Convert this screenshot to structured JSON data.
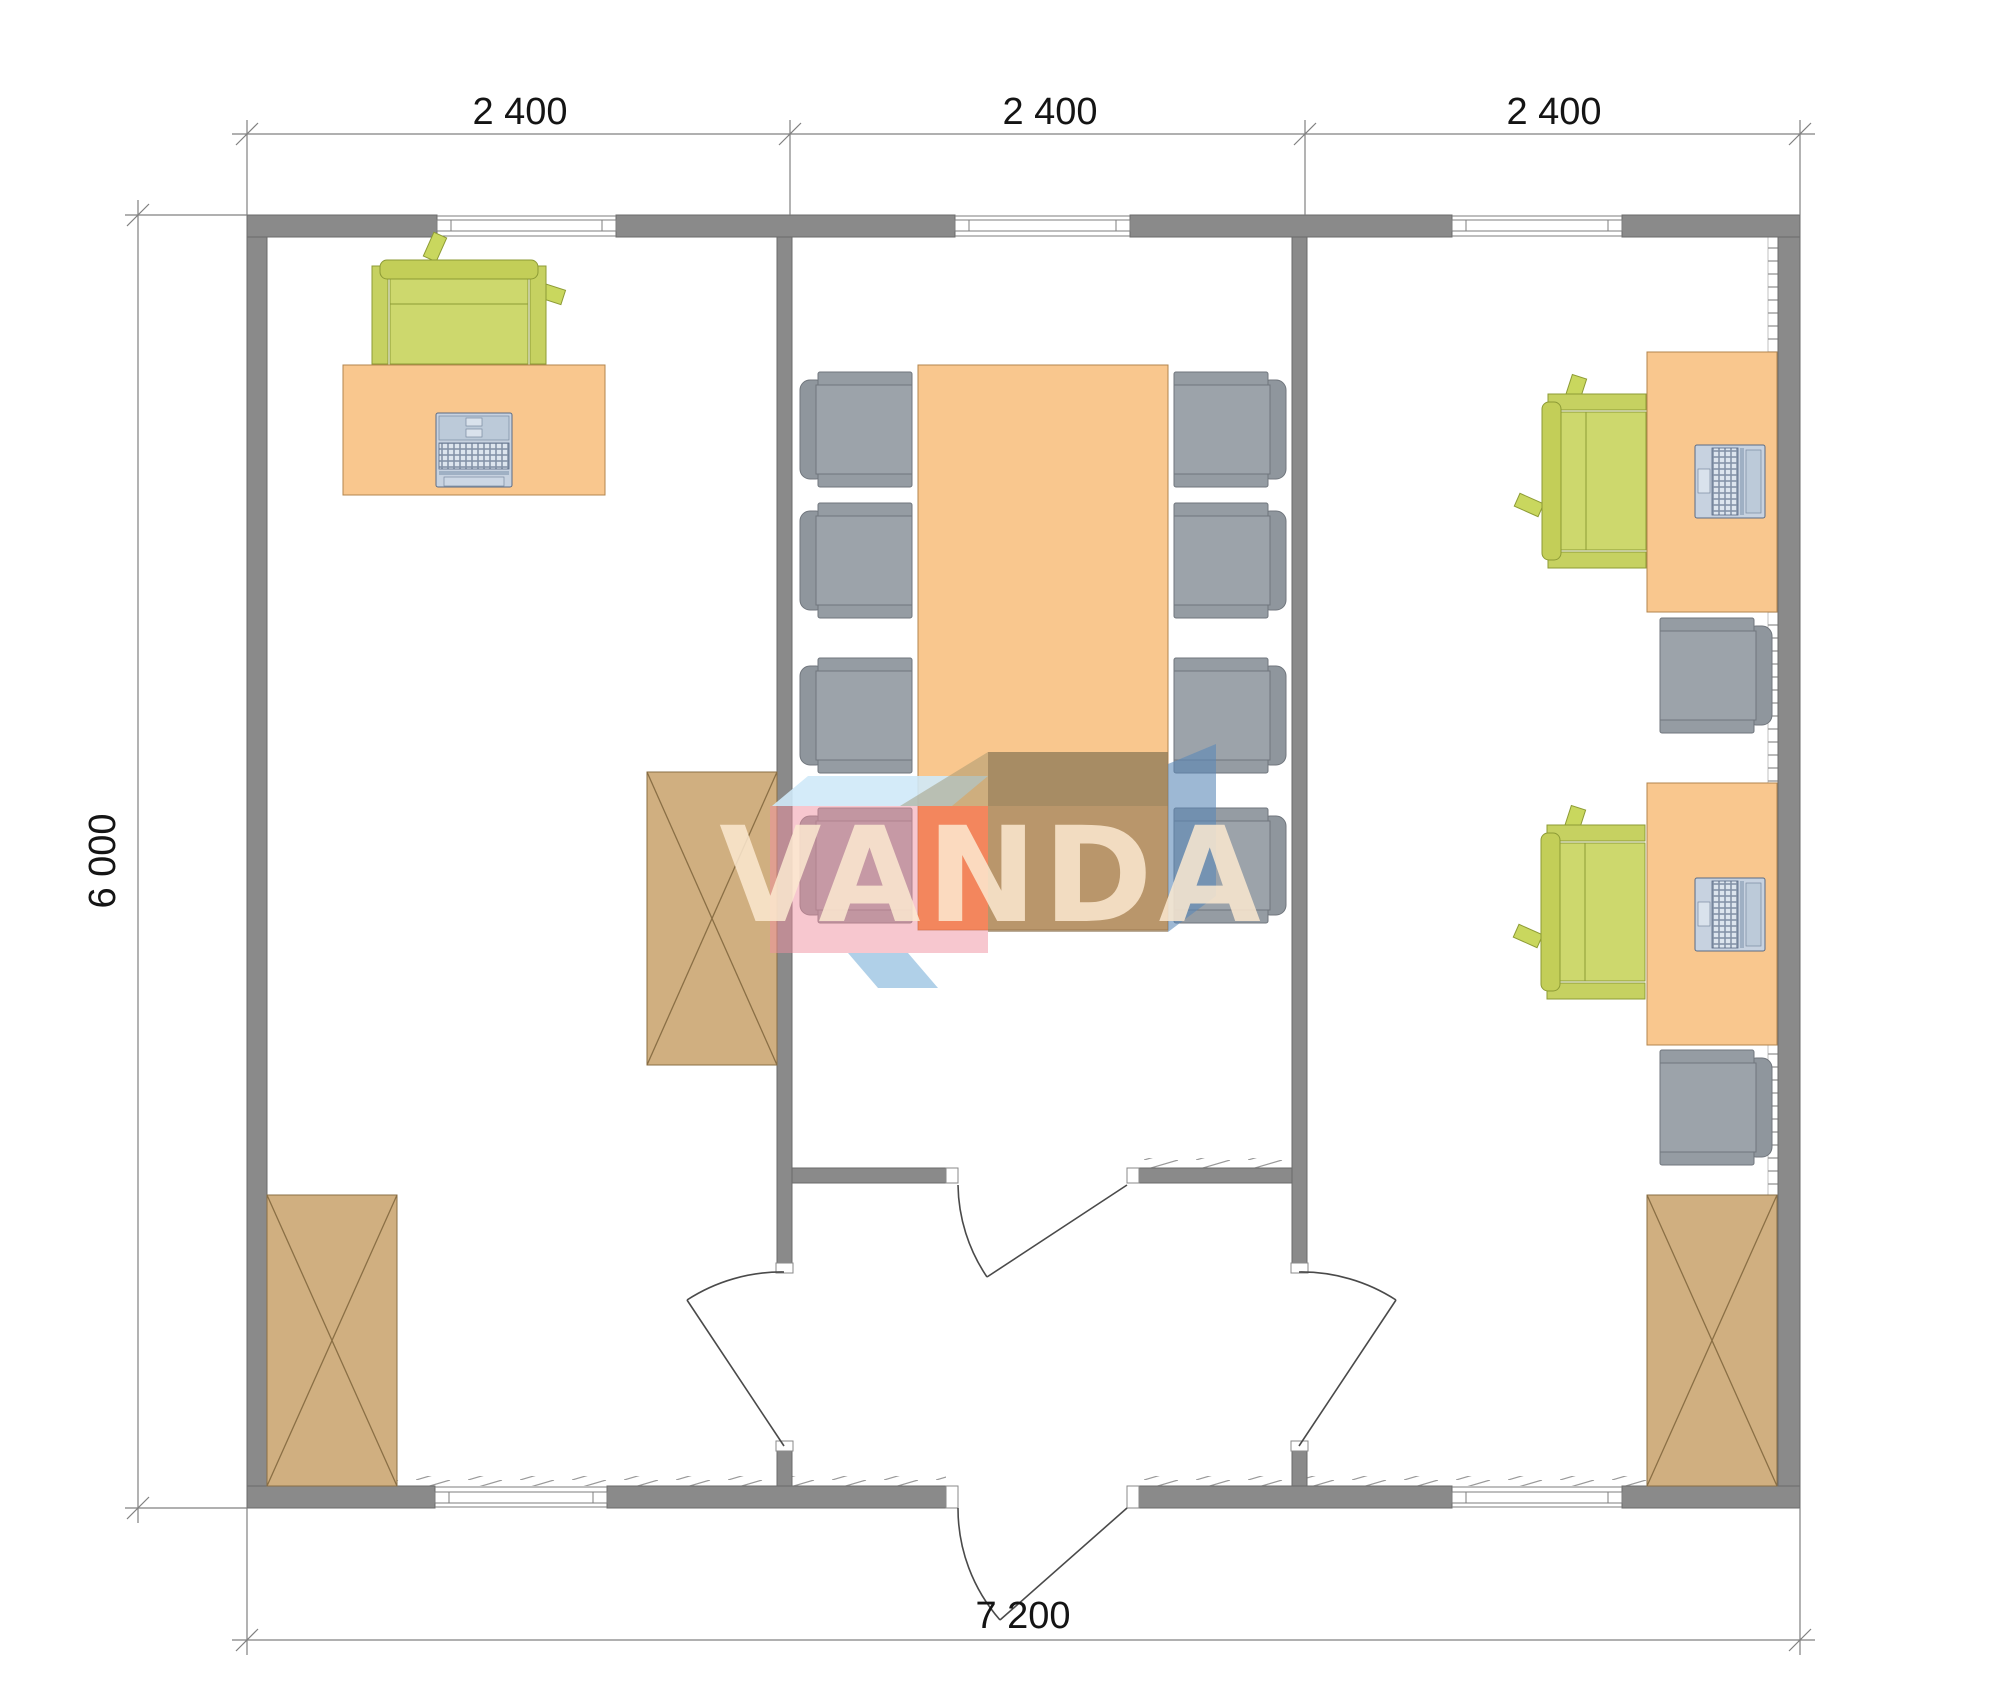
{
  "drawing": {
    "kind": "floor-plan",
    "rooms": [
      {
        "name": "office-left",
        "furniture": [
          "desk",
          "green-office-chair",
          "keyboard",
          "wardrobe-cabinet",
          "wardrobe-cabinet"
        ]
      },
      {
        "name": "meeting-room",
        "furniture": [
          "conference-table",
          "armchair x8"
        ]
      },
      {
        "name": "office-right",
        "furniture": [
          "desk x2",
          "laptop x2",
          "green-office-chair x2",
          "gray-armchair x2",
          "wardrobe-cabinet"
        ]
      },
      {
        "name": "entrance-vestibule",
        "furniture": []
      }
    ]
  },
  "dimensions": {
    "top_segments": [
      "2 400",
      "2 400",
      "2 400"
    ],
    "left_total": "6 000",
    "bottom_total": "7 200"
  },
  "watermark": {
    "text": "VANDA",
    "colors": {
      "skyblue": "#CFE9F8",
      "pink": "#EF8FA0",
      "orange": "#F2672E",
      "tan": "#8D7454",
      "blue": "#5C88B8",
      "letters": "#FCE9D0"
    }
  },
  "palette": {
    "wall": "#8A8A8A",
    "wall_outline": "#6B6B6B",
    "door_line": "#4A4A4A",
    "desk": "#F9C78E",
    "desk_outline": "#B3854D",
    "table": "#F9C78E",
    "chair_green": "#CCD76C",
    "chair_green_outline": "#8D9B35",
    "chair_gray": "#9CA3AA",
    "chair_gray_outline": "#70767D",
    "cabinet": "#D0AF80",
    "cabinet_outline": "#8A6F45",
    "laptop": "#C7D2E0",
    "laptop_outline": "#5A6B85",
    "dimension_line": "#808080",
    "dimension_text": "#141414"
  }
}
